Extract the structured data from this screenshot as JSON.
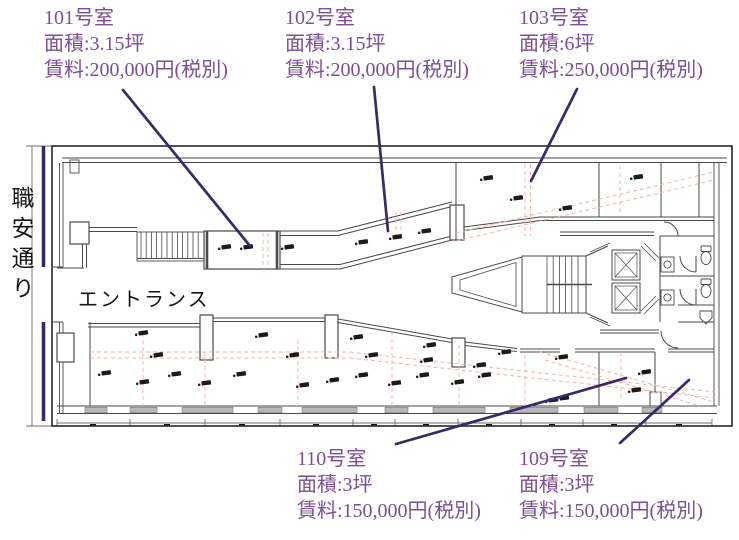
{
  "street": {
    "label": "職安通り"
  },
  "plan": {
    "entrance_label": "エントランス"
  },
  "units": [
    {
      "room": "101号室",
      "area": "面積:3.15坪",
      "rent": "賃料:200,000円(税別)"
    },
    {
      "room": "102号室",
      "area": "面積:3.15坪",
      "rent": "賃料:200,000円(税別)"
    },
    {
      "room": "103号室",
      "area": "面積:6坪",
      "rent": "賃料:250,000円(税別)"
    },
    {
      "room": "110号室",
      "area": "面積:3坪",
      "rent": "賃料:150,000円(税別)"
    },
    {
      "room": "109号室",
      "area": "面積:3坪",
      "rent": "賃料:150,000円(税別)"
    }
  ],
  "colors": {
    "label_text": "#7b4e95",
    "leader_line": "#39296a",
    "road_line": "#39296a",
    "wall": "#4a4a4a",
    "pink_guide": "#f2b4af",
    "window_fill": "#b8b8b8"
  }
}
